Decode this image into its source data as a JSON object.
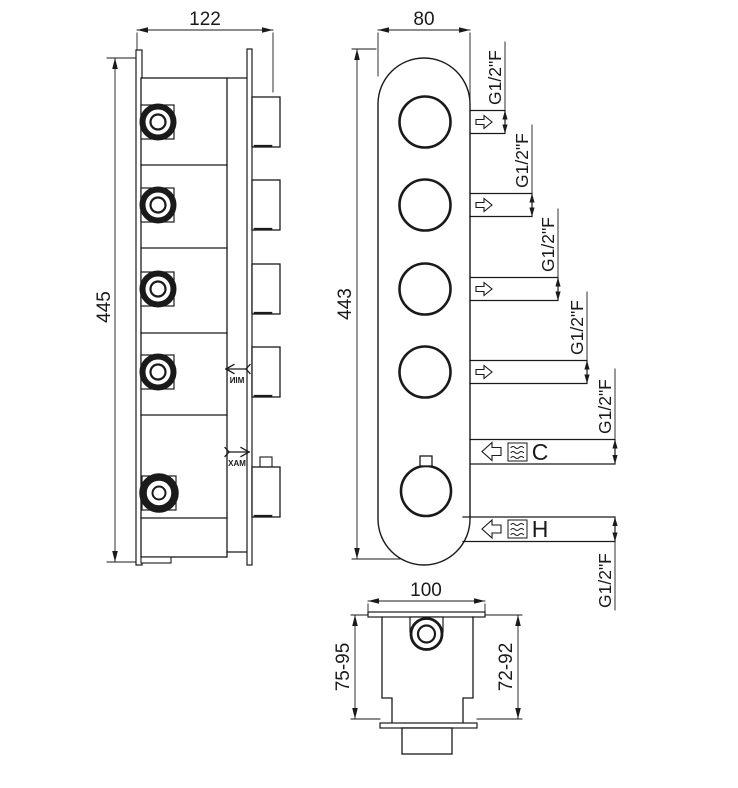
{
  "title": "Thermostatic shower valve technical drawing",
  "colors": {
    "line": "#1a1a1a",
    "background": "#ffffff"
  },
  "side_view": {
    "width_dim": "122",
    "height_dim": "445",
    "min_label": "MIN",
    "max_label": "MAX"
  },
  "front_view": {
    "width_dim": "80",
    "height_dim": "443",
    "outlets": [
      {
        "port": "G1/2\"F"
      },
      {
        "port": "G1/2\"F"
      },
      {
        "port": "G1/2\"F"
      },
      {
        "port": "G1/2\"F"
      }
    ],
    "cold_inlet": {
      "label": "C",
      "port": "G1/2\"F"
    },
    "hot_inlet": {
      "label": "H",
      "port": "G1/2\"F"
    }
  },
  "bottom_view": {
    "width_dim": "100",
    "depth_left": "75-95",
    "depth_right": "72-92"
  }
}
